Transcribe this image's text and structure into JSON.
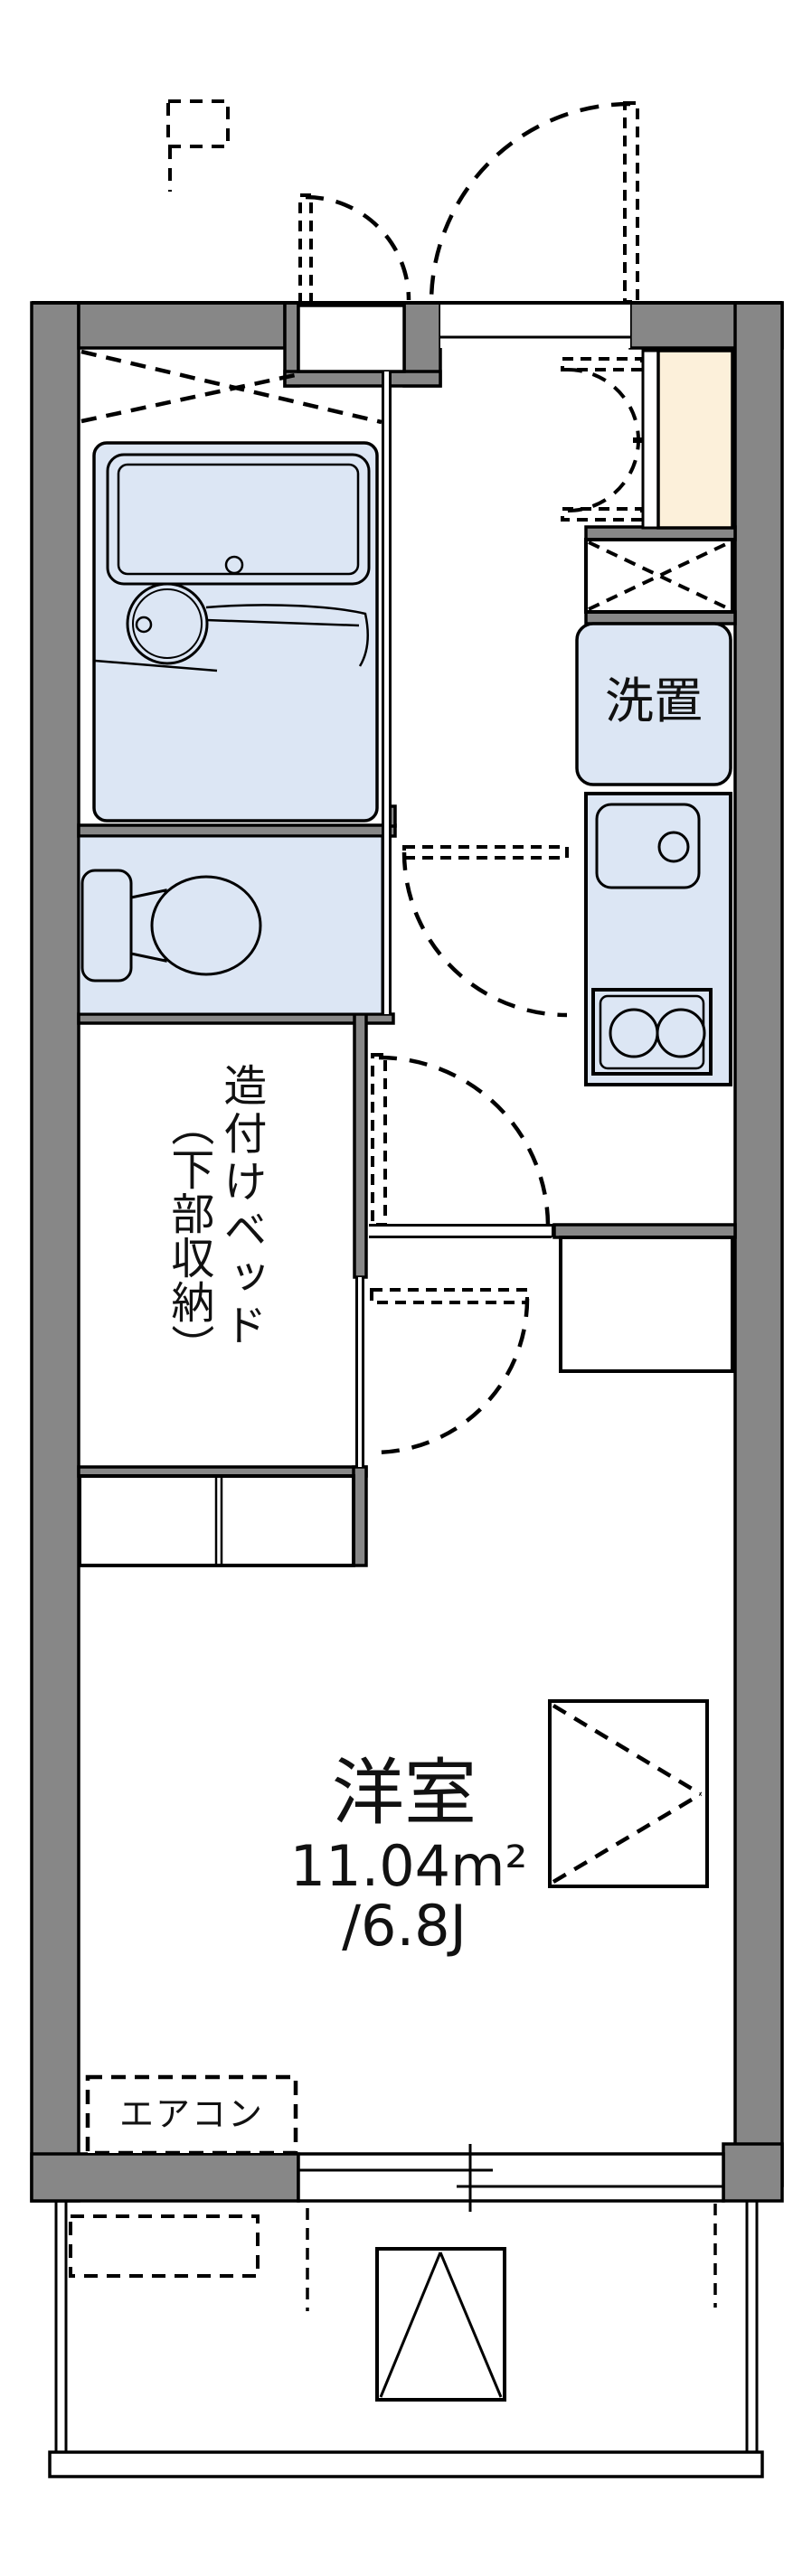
{
  "plan": {
    "title": "apartment-floor-plan",
    "labels": {
      "washer": "洗置",
      "bed_main": "造付けベッド",
      "bed_sub": "（下部収納）",
      "room_name": "洋室",
      "room_area": "11.04m²",
      "room_tatami": "/6.8J",
      "aircon": "エアコン"
    },
    "colors": {
      "wall": "#878787",
      "fixture_fill": "#dce6f4",
      "cabinet_fill": "#fcf0da",
      "outline": "#000000",
      "background": "#ffffff"
    },
    "fixtures": [
      "unit-bath",
      "bathtub",
      "wash-basin",
      "toilet",
      "built-in-bed-storage",
      "washing-machine-space",
      "kitchen-sink",
      "two-burner-stove",
      "shoe-cabinet",
      "entry-double-closet",
      "refrigerator-space",
      "wall-storage-box",
      "air-conditioner",
      "ac-outdoor-unit",
      "sliding-window",
      "balcony",
      "evacuation-hatch",
      "front-door"
    ]
  }
}
